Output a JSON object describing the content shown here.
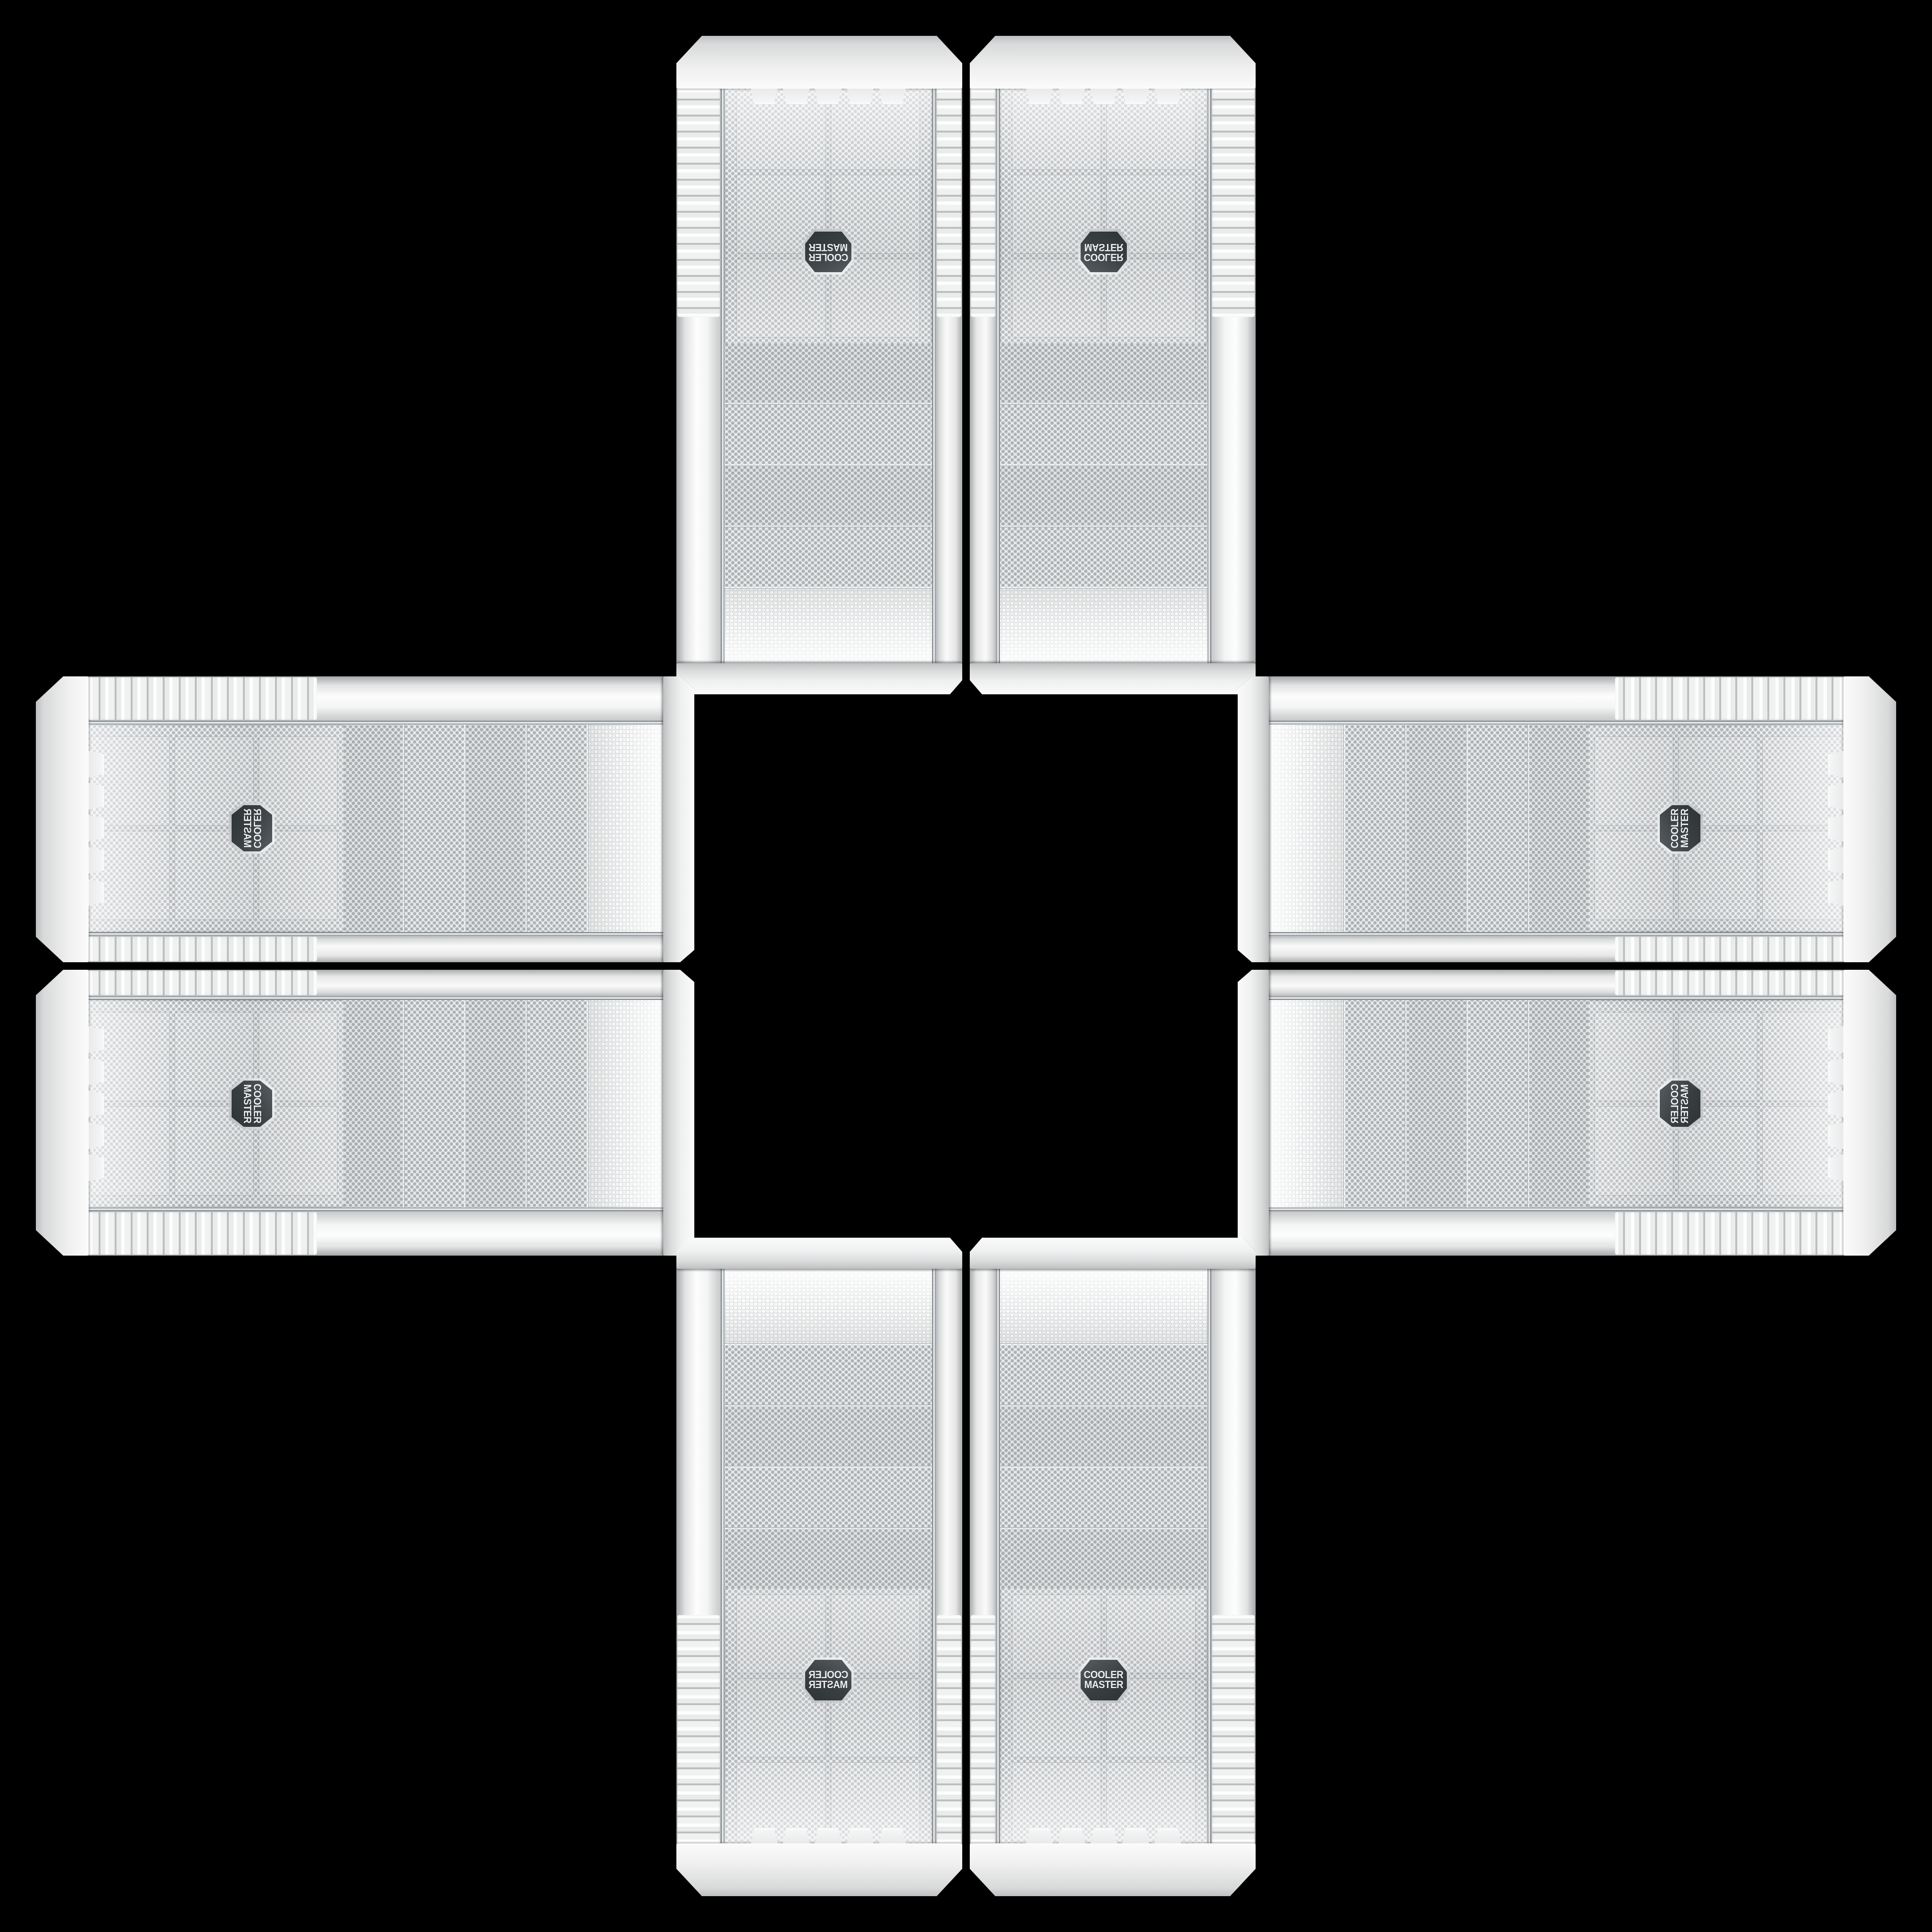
{
  "page": {
    "background": "#000000",
    "description": "Eight white Cooler Master PC case front panels arranged in a plus / cross pattern on a black background; each arm of the cross is a mirrored pair of the same panel"
  },
  "brand_badge": {
    "line1": "COOLER",
    "line2": "MASTER"
  },
  "colors": {
    "background": "#000000",
    "panel_white": "#f2f3f3",
    "rail_shadow": "#a9abac",
    "mesh_base": "#eceef0",
    "mesh_dot": "#b3b7b9",
    "strip_base": "#e2e5e6",
    "chrome_trim": "#9aa0a4",
    "badge_dark": "#3a3f42",
    "badge_text": "#eef0f1"
  },
  "panels": [
    {
      "position": "top-left",
      "orientation": "vertical",
      "flip": "rotated-180"
    },
    {
      "position": "top-right",
      "orientation": "vertical",
      "flip": "mirrored-vertical"
    },
    {
      "position": "left-top",
      "orientation": "horizontal",
      "flip": "rotated-90ccw-mirrored"
    },
    {
      "position": "right-top",
      "orientation": "horizontal",
      "flip": "rotated-90ccw"
    },
    {
      "position": "left-bottom",
      "orientation": "horizontal",
      "flip": "rotated-90cw"
    },
    {
      "position": "right-bottom",
      "orientation": "horizontal",
      "flip": "rotated-90ccw-mirrored-vertical"
    },
    {
      "position": "bottom-left",
      "orientation": "vertical",
      "flip": "mirrored-horizontal"
    },
    {
      "position": "bottom-right",
      "orientation": "vertical",
      "flip": "none"
    }
  ]
}
